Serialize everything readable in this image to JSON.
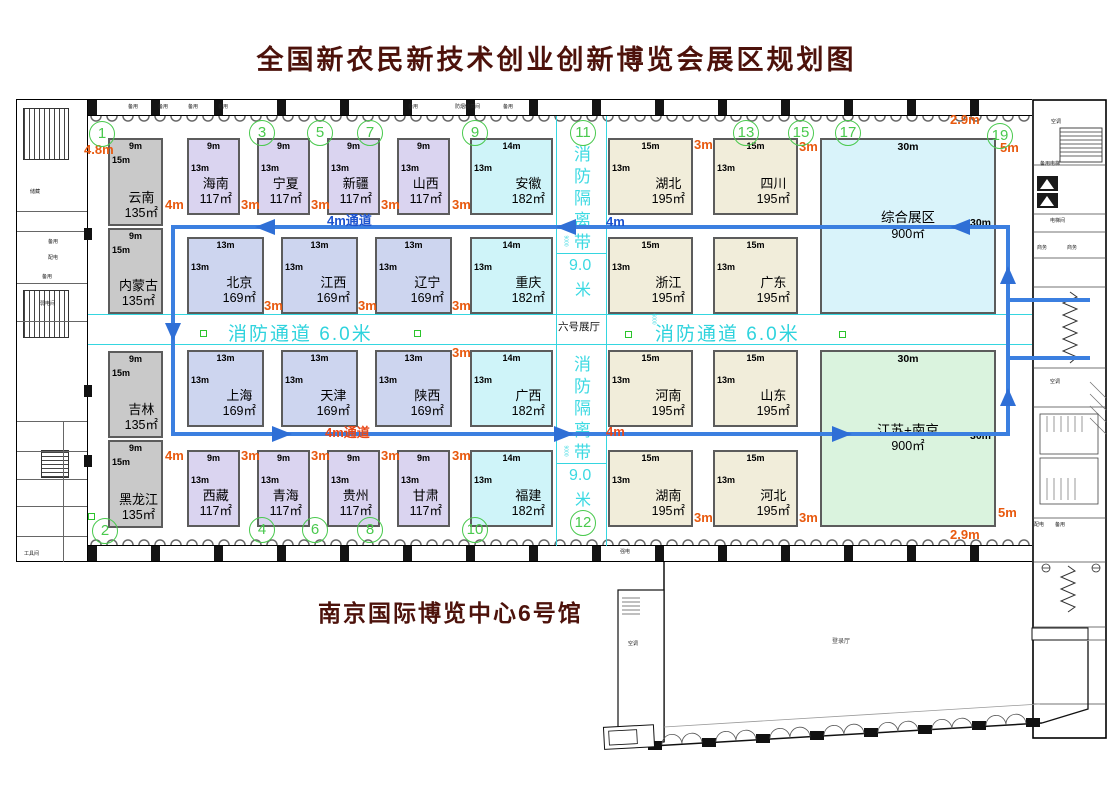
{
  "title": "全国新农民新技术创业创新博览会展区规划图",
  "venue": "南京国际博览中心6号馆",
  "hall_label": "六号展厅",
  "annex_label": "登录厅",
  "colors": {
    "title_maroon": "#4d120b",
    "route_blue": "#3b7fe0",
    "fire_cyan": "#35d6e0",
    "dimension_orange": "#e8590e",
    "circle_green": "#49c94d",
    "booth_gray": "#c9c9c9",
    "booth_purple": "#dad4f0",
    "booth_blue": "#cdd5ef",
    "booth_cyan": "#cff4f9",
    "booth_beige": "#f1edda",
    "booth_comprehensive": "#d9f3fa",
    "booth_jiangsu": "#daf3de"
  },
  "routes": {
    "top_label": "4m通道",
    "top_width": "4m",
    "bottom_label": "4m通道",
    "bottom_width": "4m"
  },
  "markers": {
    "lane_mm": "6000"
  },
  "fire_lanes": [
    {
      "label": "消防通道",
      "size": "6.0米",
      "x": 228
    },
    {
      "label": "消防通道",
      "size": "6.0米",
      "x": 655
    }
  ],
  "fire_strips": [
    {
      "chars": "消防隔离带",
      "size": "9.0",
      "unit": "米",
      "mm": "9000",
      "y": 140
    },
    {
      "chars": "消防隔离带",
      "size": "9.0",
      "unit": "米",
      "mm": "9000",
      "y": 350
    }
  ],
  "booths": [
    {
      "name": "云南",
      "area": "135㎡",
      "top": "9m",
      "side": "15m",
      "type": "gray",
      "x": 108,
      "y": 138,
      "w": 55,
      "h": 88
    },
    {
      "name": "内蒙古",
      "area": "135㎡",
      "top": "9m",
      "side": "15m",
      "type": "gray",
      "x": 108,
      "y": 228,
      "w": 55,
      "h": 86
    },
    {
      "name": "吉林",
      "area": "135㎡",
      "top": "9m",
      "side": "15m",
      "type": "gray",
      "x": 108,
      "y": 351,
      "w": 55,
      "h": 87
    },
    {
      "name": "黑龙江",
      "area": "135㎡",
      "top": "9m",
      "side": "15m",
      "type": "gray",
      "x": 108,
      "y": 440,
      "w": 55,
      "h": 88
    },
    {
      "name": "海南",
      "area": "117㎡",
      "top": "9m",
      "side": "13m",
      "type": "purple",
      "x": 187,
      "y": 138,
      "w": 53,
      "h": 77
    },
    {
      "name": "宁夏",
      "area": "117㎡",
      "top": "9m",
      "side": "13m",
      "type": "purple",
      "x": 257,
      "y": 138,
      "w": 53,
      "h": 77
    },
    {
      "name": "新疆",
      "area": "117㎡",
      "top": "9m",
      "side": "13m",
      "type": "purple",
      "x": 327,
      "y": 138,
      "w": 53,
      "h": 77
    },
    {
      "name": "山西",
      "area": "117㎡",
      "top": "9m",
      "side": "13m",
      "type": "purple",
      "x": 397,
      "y": 138,
      "w": 53,
      "h": 77
    },
    {
      "name": "安徽",
      "area": "182㎡",
      "top": "14m",
      "side": "13m",
      "type": "cyan",
      "x": 470,
      "y": 138,
      "w": 83,
      "h": 77
    },
    {
      "name": "北京",
      "area": "169㎡",
      "top": "13m",
      "side": "13m",
      "type": "blue",
      "x": 187,
      "y": 237,
      "w": 77,
      "h": 77
    },
    {
      "name": "江西",
      "area": "169㎡",
      "top": "13m",
      "side": "13m",
      "type": "blue",
      "x": 281,
      "y": 237,
      "w": 77,
      "h": 77
    },
    {
      "name": "辽宁",
      "area": "169㎡",
      "top": "13m",
      "side": "13m",
      "type": "blue",
      "x": 375,
      "y": 237,
      "w": 77,
      "h": 77
    },
    {
      "name": "重庆",
      "area": "182㎡",
      "top": "14m",
      "side": "13m",
      "type": "cyan",
      "x": 470,
      "y": 237,
      "w": 83,
      "h": 77
    },
    {
      "name": "上海",
      "area": "169㎡",
      "top": "13m",
      "side": "13m",
      "type": "blue",
      "x": 187,
      "y": 350,
      "w": 77,
      "h": 77
    },
    {
      "name": "天津",
      "area": "169㎡",
      "top": "13m",
      "side": "13m",
      "type": "blue",
      "x": 281,
      "y": 350,
      "w": 77,
      "h": 77
    },
    {
      "name": "陕西",
      "area": "169㎡",
      "top": "13m",
      "side": "13m",
      "type": "blue",
      "x": 375,
      "y": 350,
      "w": 77,
      "h": 77
    },
    {
      "name": "广西",
      "area": "182㎡",
      "top": "14m",
      "side": "13m",
      "type": "cyan",
      "x": 470,
      "y": 350,
      "w": 83,
      "h": 77
    },
    {
      "name": "西藏",
      "area": "117㎡",
      "top": "9m",
      "side": "13m",
      "type": "purple",
      "x": 187,
      "y": 450,
      "w": 53,
      "h": 77
    },
    {
      "name": "青海",
      "area": "117㎡",
      "top": "9m",
      "side": "13m",
      "type": "purple",
      "x": 257,
      "y": 450,
      "w": 53,
      "h": 77
    },
    {
      "name": "贵州",
      "area": "117㎡",
      "top": "9m",
      "side": "13m",
      "type": "purple",
      "x": 327,
      "y": 450,
      "w": 53,
      "h": 77
    },
    {
      "name": "甘肃",
      "area": "117㎡",
      "top": "9m",
      "side": "13m",
      "type": "purple",
      "x": 397,
      "y": 450,
      "w": 53,
      "h": 77
    },
    {
      "name": "福建",
      "area": "182㎡",
      "top": "14m",
      "side": "13m",
      "type": "cyan",
      "x": 470,
      "y": 450,
      "w": 83,
      "h": 77
    },
    {
      "name": "湖北",
      "area": "195㎡",
      "top": "15m",
      "side": "13m",
      "type": "beige",
      "x": 608,
      "y": 138,
      "w": 85,
      "h": 77
    },
    {
      "name": "四川",
      "area": "195㎡",
      "top": "15m",
      "side": "13m",
      "type": "beige",
      "x": 713,
      "y": 138,
      "w": 85,
      "h": 77
    },
    {
      "name": "浙江",
      "area": "195㎡",
      "top": "15m",
      "side": "13m",
      "type": "beige",
      "x": 608,
      "y": 237,
      "w": 85,
      "h": 77
    },
    {
      "name": "广东",
      "area": "195㎡",
      "top": "15m",
      "side": "13m",
      "type": "beige",
      "x": 713,
      "y": 237,
      "w": 85,
      "h": 77
    },
    {
      "name": "河南",
      "area": "195㎡",
      "top": "15m",
      "side": "13m",
      "type": "beige",
      "x": 608,
      "y": 350,
      "w": 85,
      "h": 77
    },
    {
      "name": "山东",
      "area": "195㎡",
      "top": "15m",
      "side": "13m",
      "type": "beige",
      "x": 713,
      "y": 350,
      "w": 85,
      "h": 77
    },
    {
      "name": "湖南",
      "area": "195㎡",
      "top": "15m",
      "side": "13m",
      "type": "beige",
      "x": 608,
      "y": 450,
      "w": 85,
      "h": 77
    },
    {
      "name": "河北",
      "area": "195㎡",
      "top": "15m",
      "side": "13m",
      "type": "beige",
      "x": 713,
      "y": 450,
      "w": 85,
      "h": 77
    },
    {
      "name": "综合展区",
      "area": "900㎡",
      "top": "30m",
      "side": "30m",
      "type": "xlcyan",
      "x": 820,
      "y": 138,
      "w": 176,
      "h": 176
    },
    {
      "name": "江苏+南京",
      "area": "900㎡",
      "top": "30m",
      "side": "30m",
      "type": "xlgreen",
      "x": 820,
      "y": 350,
      "w": 176,
      "h": 177
    }
  ],
  "dims": [
    {
      "v": "4.8m",
      "x": 84,
      "y": 142
    },
    {
      "v": "4m",
      "x": 165,
      "y": 197
    },
    {
      "v": "3m",
      "x": 241,
      "y": 197
    },
    {
      "v": "3m",
      "x": 311,
      "y": 197
    },
    {
      "v": "3m",
      "x": 381,
      "y": 197
    },
    {
      "v": "3m",
      "x": 452,
      "y": 197
    },
    {
      "v": "3m",
      "x": 694,
      "y": 137
    },
    {
      "v": "3m",
      "x": 799,
      "y": 139
    },
    {
      "v": "2.9m",
      "x": 950,
      "y": 112
    },
    {
      "v": "5m",
      "x": 1000,
      "y": 140
    },
    {
      "v": "3m",
      "x": 264,
      "y": 298
    },
    {
      "v": "3m",
      "x": 358,
      "y": 298
    },
    {
      "v": "3m",
      "x": 452,
      "y": 298
    },
    {
      "v": "3m",
      "x": 452,
      "y": 345
    },
    {
      "v": "4m",
      "x": 165,
      "y": 448
    },
    {
      "v": "3m",
      "x": 241,
      "y": 448
    },
    {
      "v": "3m",
      "x": 311,
      "y": 448
    },
    {
      "v": "3m",
      "x": 381,
      "y": 448
    },
    {
      "v": "3m",
      "x": 452,
      "y": 448
    },
    {
      "v": "3m",
      "x": 694,
      "y": 510
    },
    {
      "v": "3m",
      "x": 799,
      "y": 510
    },
    {
      "v": "5m",
      "x": 998,
      "y": 505
    },
    {
      "v": "2.9m",
      "x": 950,
      "y": 527
    }
  ],
  "circles": [
    {
      "n": "1",
      "x": 102,
      "y": 134
    },
    {
      "n": "3",
      "x": 262,
      "y": 133
    },
    {
      "n": "5",
      "x": 320,
      "y": 133
    },
    {
      "n": "7",
      "x": 370,
      "y": 133
    },
    {
      "n": "9",
      "x": 475,
      "y": 133
    },
    {
      "n": "11",
      "x": 583,
      "y": 133
    },
    {
      "n": "13",
      "x": 746,
      "y": 133
    },
    {
      "n": "15",
      "x": 801,
      "y": 133
    },
    {
      "n": "17",
      "x": 848,
      "y": 133
    },
    {
      "n": "19",
      "x": 1000,
      "y": 136
    },
    {
      "n": "2",
      "x": 105,
      "y": 531
    },
    {
      "n": "4",
      "x": 262,
      "y": 530
    },
    {
      "n": "6",
      "x": 315,
      "y": 530
    },
    {
      "n": "8",
      "x": 370,
      "y": 530
    },
    {
      "n": "10",
      "x": 475,
      "y": 530
    },
    {
      "n": "12",
      "x": 583,
      "y": 523
    }
  ],
  "room_labels": [
    {
      "t": "备用",
      "x": 128,
      "y": 103
    },
    {
      "t": "备用",
      "x": 158,
      "y": 103
    },
    {
      "t": "备用",
      "x": 188,
      "y": 103
    },
    {
      "t": "备用",
      "x": 218,
      "y": 103
    },
    {
      "t": "备用",
      "x": 408,
      "y": 103
    },
    {
      "t": "防烟储藏间",
      "x": 455,
      "y": 103
    },
    {
      "t": "备用",
      "x": 503,
      "y": 103
    },
    {
      "t": "储藏",
      "x": 30,
      "y": 188
    },
    {
      "t": "备用",
      "x": 48,
      "y": 238
    },
    {
      "t": "配电",
      "x": 48,
      "y": 254
    },
    {
      "t": "备用",
      "x": 42,
      "y": 273
    },
    {
      "t": "弱电间",
      "x": 40,
      "y": 300
    },
    {
      "t": "工具间",
      "x": 24,
      "y": 550
    },
    {
      "t": "强电",
      "x": 620,
      "y": 548
    },
    {
      "t": "空调",
      "x": 1051,
      "y": 118
    },
    {
      "t": "备用电梯",
      "x": 1040,
      "y": 160
    },
    {
      "t": "电梯间",
      "x": 1050,
      "y": 217
    },
    {
      "t": "商务",
      "x": 1037,
      "y": 244
    },
    {
      "t": "商务",
      "x": 1067,
      "y": 244
    },
    {
      "t": "空调",
      "x": 1050,
      "y": 378
    },
    {
      "t": "配电",
      "x": 1034,
      "y": 521
    },
    {
      "t": "备用",
      "x": 1055,
      "y": 521
    },
    {
      "t": "空调",
      "x": 628,
      "y": 640
    }
  ]
}
